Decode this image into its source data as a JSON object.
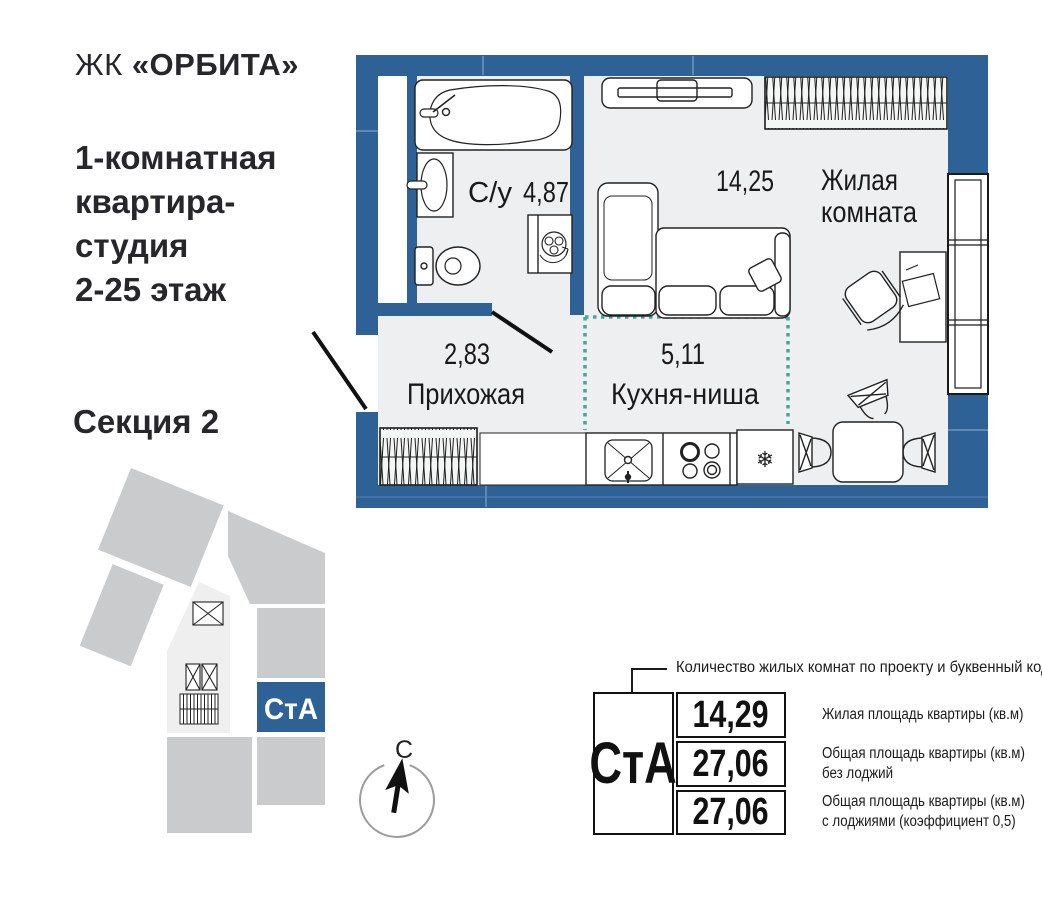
{
  "brand": {
    "prefix": "ЖК",
    "name": "«ОРБИТА»"
  },
  "title_lines": [
    "1-комнатная",
    "квартира-",
    "студия",
    "2-25 этаж"
  ],
  "section_label": "Секция 2",
  "plan": {
    "rooms": {
      "bathroom": {
        "label": "С/у",
        "area": "4,87"
      },
      "living": {
        "area": "14,25",
        "name_line1": "Жилая",
        "name_line2": "комната"
      },
      "hallway": {
        "area": "2,83",
        "name": "Прихожая"
      },
      "kitchen": {
        "area": "5,11",
        "name": "Кухня-ниша"
      }
    }
  },
  "locator": {
    "unit_code": "СтА"
  },
  "compass": {
    "north_letter": "С"
  },
  "legend": {
    "code": "СтА",
    "note": "Количество жилых комнат по проекту и буквенный код",
    "rows": [
      {
        "value": "14,29",
        "desc": [
          "Жилая площадь квартиры (кв.м)"
        ]
      },
      {
        "value": "27,06",
        "desc": [
          "Общая площадь квартиры (кв.м)",
          "без лоджий"
        ]
      },
      {
        "value": "27,06",
        "desc": [
          "Общая площадь квартиры (кв.м)",
          "с лоджиями (коэффициент 0,5)"
        ]
      }
    ]
  },
  "icons": {
    "snowflake": "❄"
  },
  "colors": {
    "wall_blue": "#2e6296",
    "accent_teal": "#43a79f",
    "block_gray": "#c9cbcd",
    "core_gray": "#efefef",
    "floor_gray": "#edeff0",
    "ink": "#1a1a1a"
  }
}
